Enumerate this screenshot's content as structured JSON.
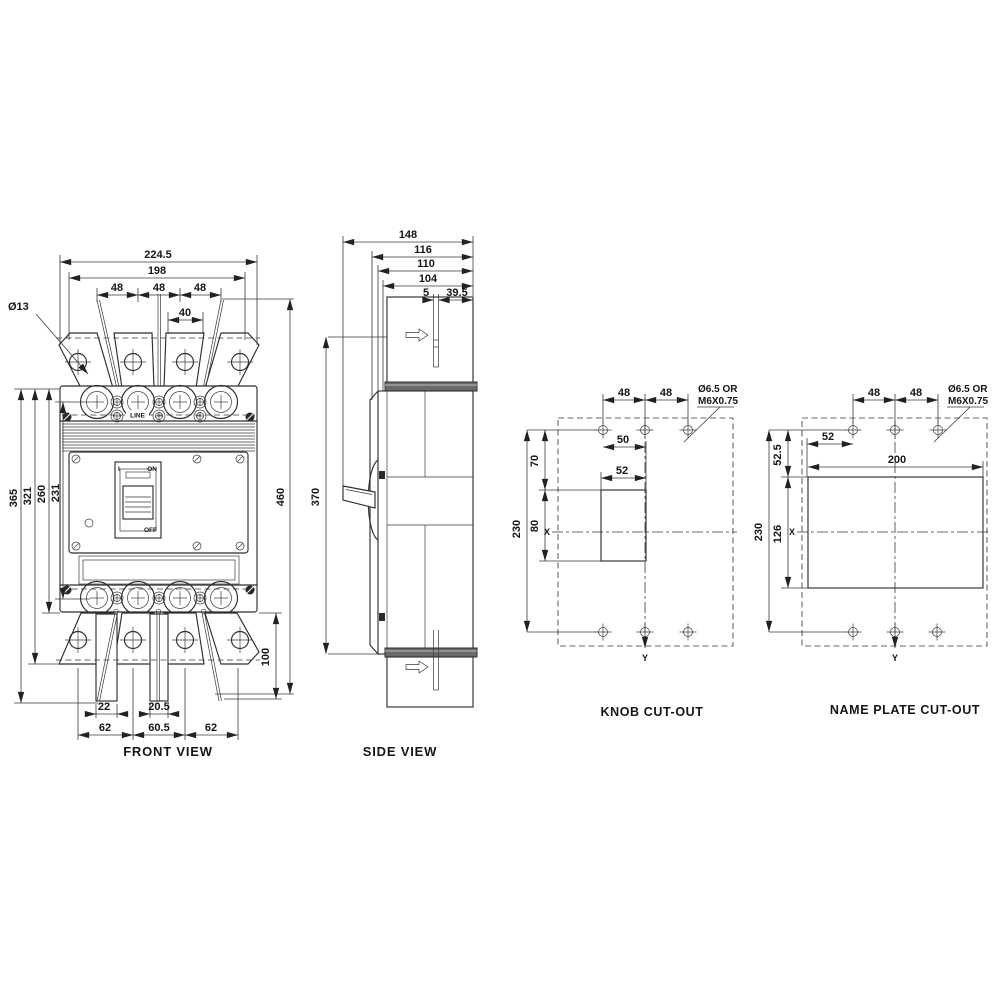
{
  "palette": {
    "background": "#ffffff",
    "line": "#2f2f2f",
    "dim_line": "#3a3a3a",
    "text": "#161616"
  },
  "views": {
    "front": {
      "title": "FRONT VIEW",
      "dims": {
        "overall_width": "224.5",
        "mounting_width": "198",
        "pole_pitch": [
          "48",
          "48",
          "48"
        ],
        "center_gap": "40",
        "hole_note": "Ø13",
        "left_heights": [
          "365",
          "321",
          "260",
          "231"
        ],
        "overall_height": "460",
        "extension_drop": "100",
        "tab_left": "22",
        "tab_center": "20.5",
        "bottom_pitch": [
          "62",
          "60.5",
          "62"
        ]
      },
      "face": {
        "line_label": "LINE",
        "on": "ON",
        "off": "OFF",
        "handle_i": "I"
      }
    },
    "side": {
      "title": "SIDE VIEW",
      "dims": {
        "depth_overall": "148",
        "depth_116": "116",
        "depth_110": "110",
        "depth_104": "104",
        "gap_5": "5",
        "back_39_5": "39.5",
        "body_height": "370"
      }
    },
    "knob": {
      "title": "KNOB CUT-OUT",
      "hole_note": [
        "Ø6.5 OR",
        "M6X0.75"
      ],
      "dims": {
        "pitch": [
          "48",
          "48"
        ],
        "top_width": "50",
        "window_width": "52",
        "upper_height": "70",
        "window_height": "80",
        "total_height": "230"
      },
      "axes": {
        "x": "X",
        "y": "Y"
      }
    },
    "nameplate": {
      "title": "NAME PLATE CUT-OUT",
      "hole_note": [
        "Ø6.5 OR",
        "M6X0.75"
      ],
      "dims": {
        "pitch": [
          "48",
          "48"
        ],
        "offset": "52",
        "window_width": "200",
        "upper_height": "52.5",
        "window_height": "126",
        "total_height": "230"
      },
      "axes": {
        "x": "X",
        "y": "Y"
      }
    }
  }
}
